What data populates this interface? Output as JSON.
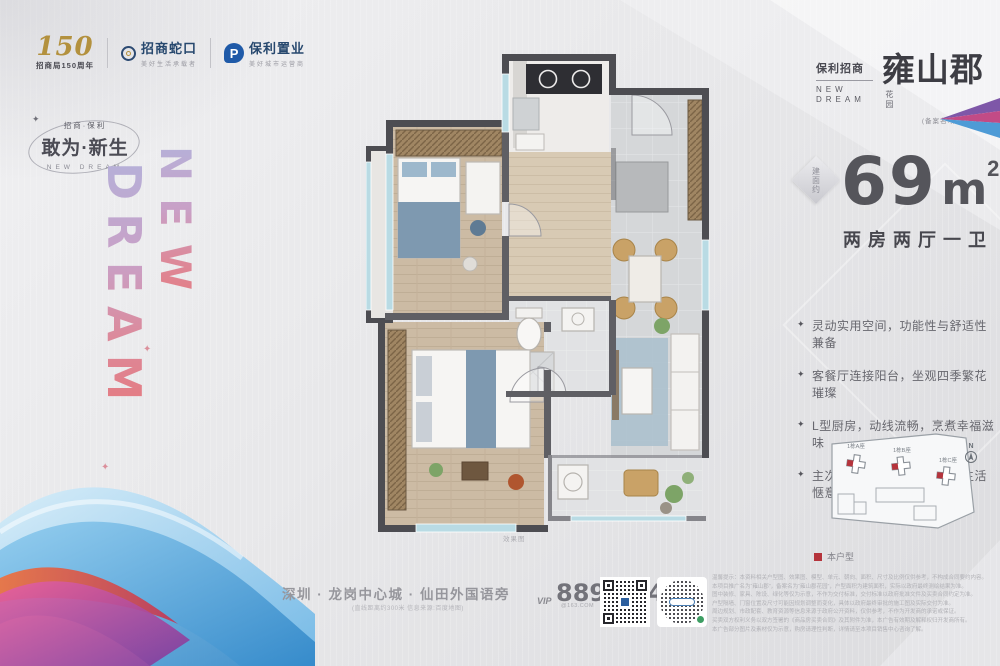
{
  "header": {
    "logo_150": {
      "number": "150",
      "label": "招商局150周年"
    },
    "logo_cmsk": {
      "name": "招商蛇口",
      "slogan": "美好生活承载者"
    },
    "logo_poly": {
      "mark": "P",
      "name": "保利置业",
      "slogan": "美好城市运营商"
    }
  },
  "slogan_block": {
    "sparkle": "✦",
    "small": "招商·保利",
    "main": "敢为·新生",
    "sub": "NEW DREAM"
  },
  "vertical_brand": {
    "col_left": "DREAM",
    "col_right": "NEW",
    "sparkle": "✦"
  },
  "project_logo": {
    "brand": "保利招商",
    "brand_en_1": "NEW",
    "brand_en_2": "DREAM",
    "name": "雍山郡",
    "suffix": "花园",
    "record_name": "(备案名:雍山郡花园)"
  },
  "unit_info": {
    "badge": "建面约",
    "area": "69",
    "area_unit": "m",
    "area_sup": "2",
    "layout": "两房两厅一卫"
  },
  "features": [
    "灵动实用空间，功能性与舒适性兼备",
    "客餐厅连接阳台，坐观四季繁花璀璨",
    "L型厨房，动线流畅，烹煮幸福滋味",
    "主次卧配备飘窗，实用美观生活惬意"
  ],
  "feature_bullet": "✦",
  "site_plan": {
    "buildings": [
      "1栋A座",
      "1栋B座",
      "1栋C座"
    ],
    "north_label": "N",
    "legend_label": "本户型",
    "highlight_color": "#b5343c"
  },
  "floor_plan": {
    "caption": "效果图"
  },
  "contact": {
    "address": "深圳 · 龙岗中心城 · 仙田外国语旁",
    "address_note": "(直线距离约300米 信息来源:百度地图)",
    "vip_label": "VIP",
    "phone": "8898 9488",
    "phone_suffix": "@163.COM"
  },
  "disclaimer": {
    "lines": [
      "温馨提示：本资料相关户型图、效果图、模型、单元、朝向、面积、尺寸及比例仅供参考，不构成合同要约内容。",
      "本项目推广名为“雍山郡”，备案名为“雍山郡花园”，户型面积为建筑面积，实际以政府最终测绘结果为准。",
      "图中装修、家具、陈设、绿化等仅为示意，不作为交付标准，交付标准以政府批准文件及买卖合同约定为准。",
      "户型隔墙、门窗位置及尺寸可能因规划调整而变化，具体以政府最终审批的施工图及实际交付为准。",
      "周边规划、市政配套、教育资源等信息来源于政府公开资料，仅供参考，不作为开发商的承诺或保证。",
      "买卖双方权利义务以双方签署的《商品房买卖合同》及其附件为准，本广告有效期及解释权归开发商所有。",
      "本广告部分图片及素材仅为示意，购房请理性判断，详情请至本项目销售中心咨询了解。"
    ]
  },
  "colors": {
    "accent_red": "#b5343c",
    "text_dark": "#55555b",
    "text_gray": "#96969c"
  }
}
